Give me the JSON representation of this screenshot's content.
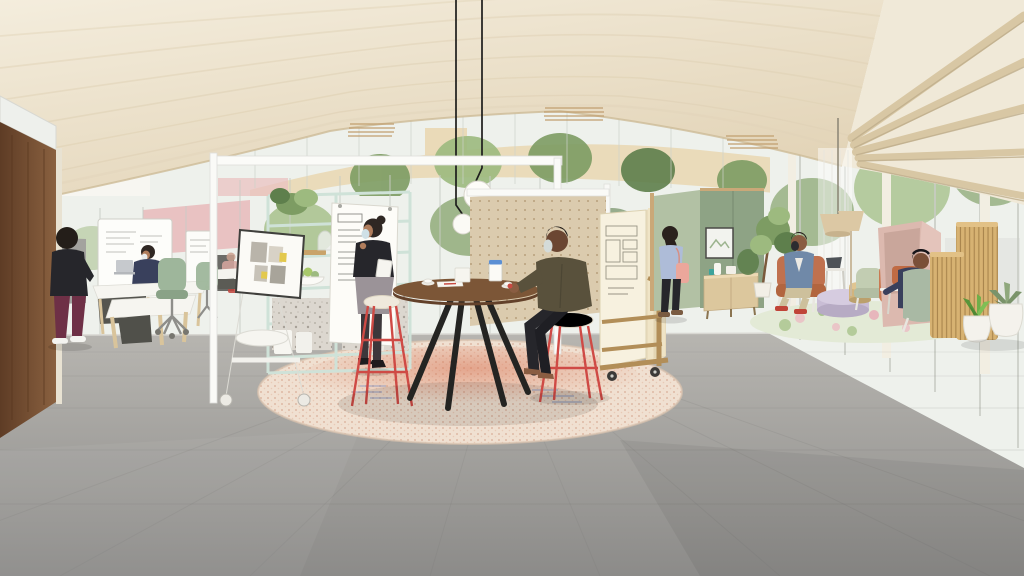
{
  "meta": {
    "title": "Architectural rendering of an open-plan collaborative office with wood ceiling, glass walls and lounge zones",
    "width": 1024,
    "height": 576,
    "visible_text": "none (handwriting on whiteboards and sketches is illegible at render scale)"
  },
  "palette": {
    "ceiling_wood": "#ece1cb",
    "ceiling_deep": "#e2d3b6",
    "glass_tint": "#eef1ec",
    "pink_wall": "#e9c2c2",
    "lavender_wall": "#e4d4e6",
    "tan_building": "#e9d7b2",
    "foliage": "#7d9c63",
    "foliage_dark": "#5e7f4c",
    "foliage_light": "#9dba7f",
    "walnut": "#7a5134",
    "mint": "#cfe2d8",
    "gray_partition": "#a3a29e",
    "table_wood": "#7c5637",
    "black_fabric": "#26262b",
    "olive_shirt": "#59513c",
    "skin_dark": "#6b4632",
    "skin_medium": "#8a5d42",
    "skin_light": "#b07d5c",
    "navy_top": "#39405c",
    "burgundy_pants": "#6e3046",
    "gray_skirt": "#9b9398",
    "green_chair": "#9eb69b",
    "pegboard": "#dbcbae",
    "cream_panel": "#f7f1df",
    "cart_wood": "#b28e58",
    "periwinkle": "#aebcd8",
    "pink_bag": "#eba79b",
    "sage_pod": "#8ea385",
    "sage_light": "#b2c1a4",
    "sideboard_wood": "#dcc79d",
    "rust_chair": "#c0714e",
    "denim": "#7089a8",
    "khaki": "#cdc09c",
    "blush_pod": "#dcb9af",
    "lavender_table": "#c9bdd5",
    "tan_pouf": "#d2b47e",
    "pale_green_chair": "#c2cdb2",
    "slat_wood": "#d7b272",
    "rug_base": "#f0e0d1",
    "rug_red": "#d97555",
    "rug_blue": "#8595c4",
    "lounge_rug": "#e3ead6",
    "accent_red": "#cf4a45",
    "mask_blue": "#cfe0e6",
    "lamp_shade": "#dcc8a4",
    "teal_cup": "#3da39b",
    "leg_wood": "#d9c49b",
    "floor_light": "#b7b5b0",
    "floor_dark": "#8c8b89"
  },
  "scene": {
    "setting": "daylit open office interior, curved light-wood plank ceiling with arched clerestory over an interior courtyard of olive trees; exposed rafters and floor-to-ceiling glazing on the right; large grey concrete floor tiles",
    "areas": [
      {
        "name": "desk-zone-left",
        "objects": [
          "dark walnut partition with glass top",
          "grey acoustic screens",
          "mobile whiteboards with handwriting",
          "two white desks with wood legs and grey modesty panels",
          "silver laptop",
          "two sage-green task chairs",
          "pink back wall"
        ]
      },
      {
        "name": "collaboration-hub-center",
        "objects": [
          "white post-and-beam canopy frame",
          "mint-green open shelving with plant, vases, whiteboard sheet and bowl of pears",
          "white mobile easel with mood-board and seat",
          "round walnut table on black splayed legs",
          "two cream bar stools with red wire frames",
          "tablet, coffee cups, papers and carton on table",
          "circular rug with red/blue dotted pattern",
          "two black-corded white globe pendants"
        ]
      },
      {
        "name": "pinboard-and-screens",
        "objects": [
          "tan perforated pegboard wall",
          "cart stacking cream folding screens with architectural sketches"
        ]
      },
      {
        "name": "meeting-pods-right",
        "objects": [
          "sage-green acoustic meeting pod with framed artwork",
          "light-wood sideboard with vase and teal mug",
          "potted indoor tree"
        ]
      },
      {
        "name": "lounge-right",
        "objects": [
          "sheer curtain",
          "tan cone pendant and floor lamp",
          "rust armchair with white frame",
          "side table with laptop",
          "lavender round coffee table",
          "tan drum pouf",
          "pale-green easy chair",
          "orange easy chair",
          "floral green lounge rug",
          "blush privacy pod with orange cushion",
          "sage wing chair",
          "vertical wood-slat screens",
          "two white planters with aloe and agave"
        ]
      }
    ],
    "people": [
      {
        "id": "standing-man-left",
        "clothing": "black t-shirt, burgundy trousers, white sneakers",
        "pose": "standing, facing desk zone"
      },
      {
        "id": "seated-woman-desk",
        "clothing": "navy top, white face mask",
        "pose": "seated at desk with laptop"
      },
      {
        "id": "presenter-woman",
        "clothing": "black top, grey pencil skirt, light-blue face mask, holds tablet",
        "pose": "standing by shelf talking"
      },
      {
        "id": "seated-man-table",
        "clothing": "olive shirt, black trousers, grey face mask, sandals",
        "pose": "seated on red-frame stool, gesturing"
      },
      {
        "id": "walking-woman",
        "clothing": "periwinkle blouse, black trousers, salmon tote bag",
        "pose": "walking away toward pods"
      },
      {
        "id": "lounge-man",
        "clothing": "denim jacket, khaki trousers, red shoes, black face mask",
        "pose": "seated in rust armchair"
      },
      {
        "id": "pod-reader",
        "clothing": "dark navy outfit, headphones",
        "pose": "seated in sage chair facing blush pod"
      }
    ]
  }
}
